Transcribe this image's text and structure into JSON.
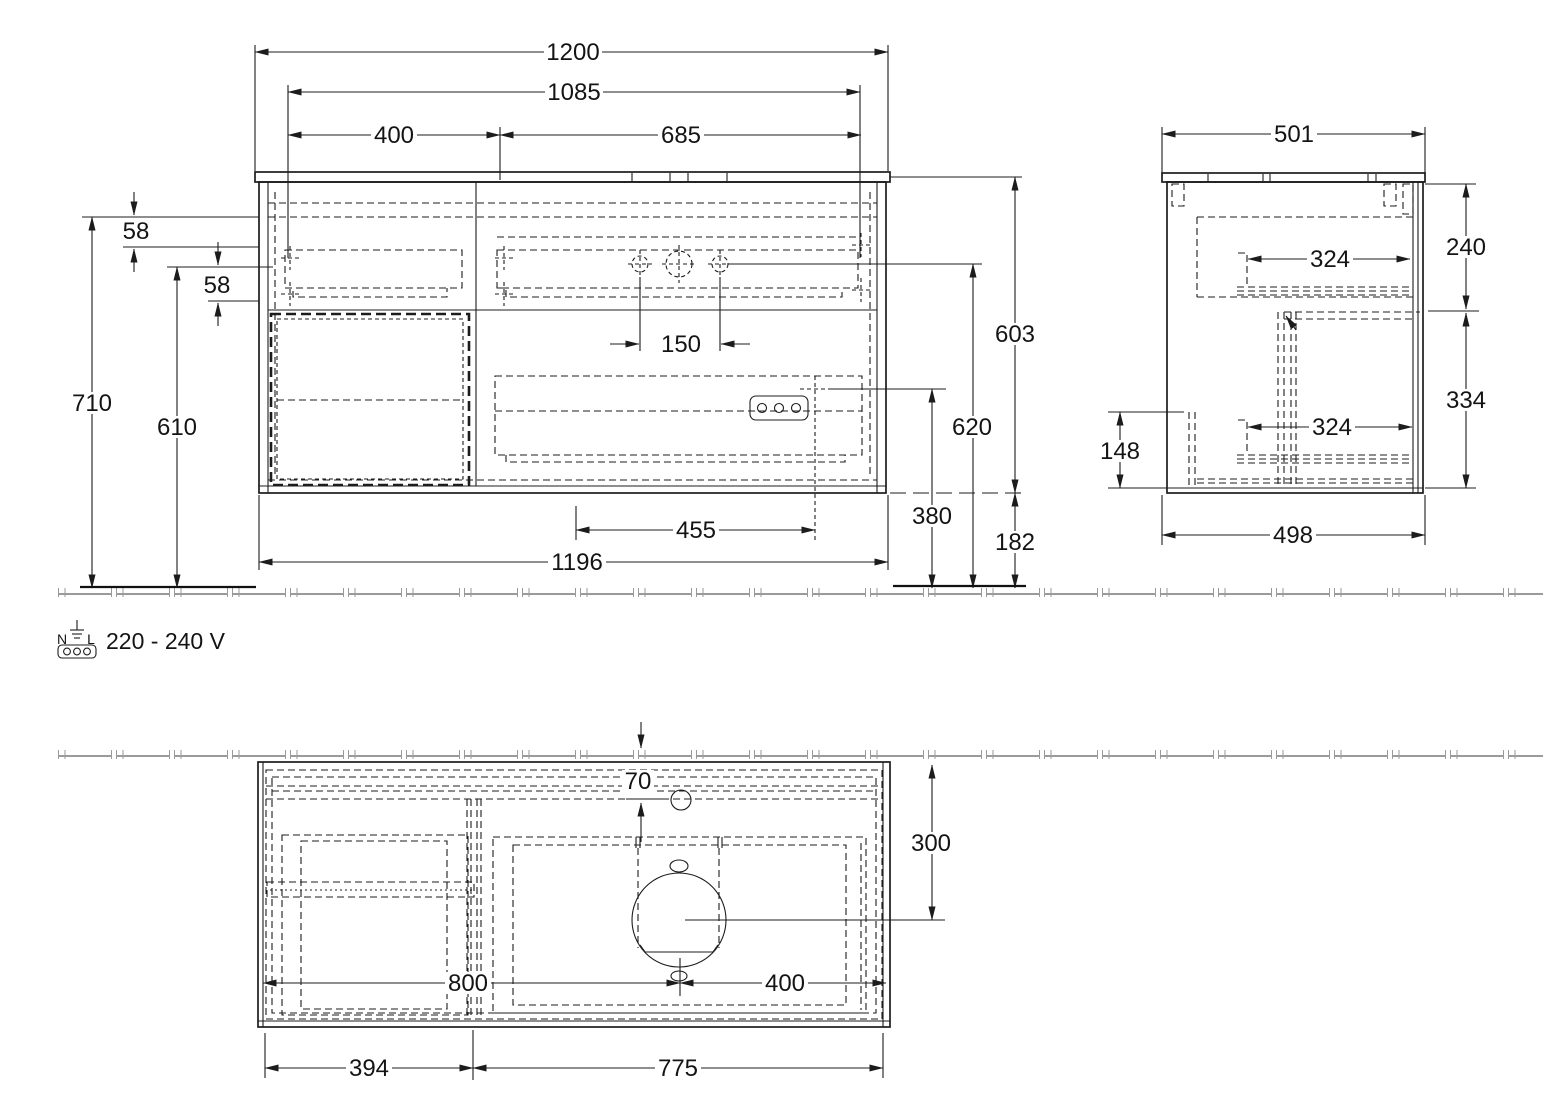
{
  "drawing": {
    "front_view": {
      "dims": {
        "total_width": "1200",
        "inner_width": "1085",
        "left_section_width": "400",
        "right_section_width": "685",
        "top_offset": "58",
        "second_offset": "58",
        "faucet_hole_spacing": "150",
        "total_height": "710",
        "inner_height": "610",
        "cabinet_height": "603",
        "faucet_height": "620",
        "socket_height": "380",
        "floor_clearance": "182",
        "trap_offset": "455",
        "body_width": "1196"
      }
    },
    "side_view": {
      "dims": {
        "total_depth": "501",
        "top_drawer_zone": "240",
        "top_drawer_depth": "324",
        "bottom_drawer_zone": "334",
        "bottom_drawer_depth": "324",
        "recess_height": "148",
        "body_depth": "498"
      }
    },
    "plan_view": {
      "dims": {
        "faucet_edge_offset": "70",
        "basin_center_depth": "300",
        "basin_center_from_left": "800",
        "basin_center_from_right": "400",
        "left_section_width": "394",
        "right_section_width": "775"
      }
    },
    "power": {
      "voltage_label": "220 - 240 V",
      "pin_left": "N",
      "pin_right": "L"
    }
  }
}
